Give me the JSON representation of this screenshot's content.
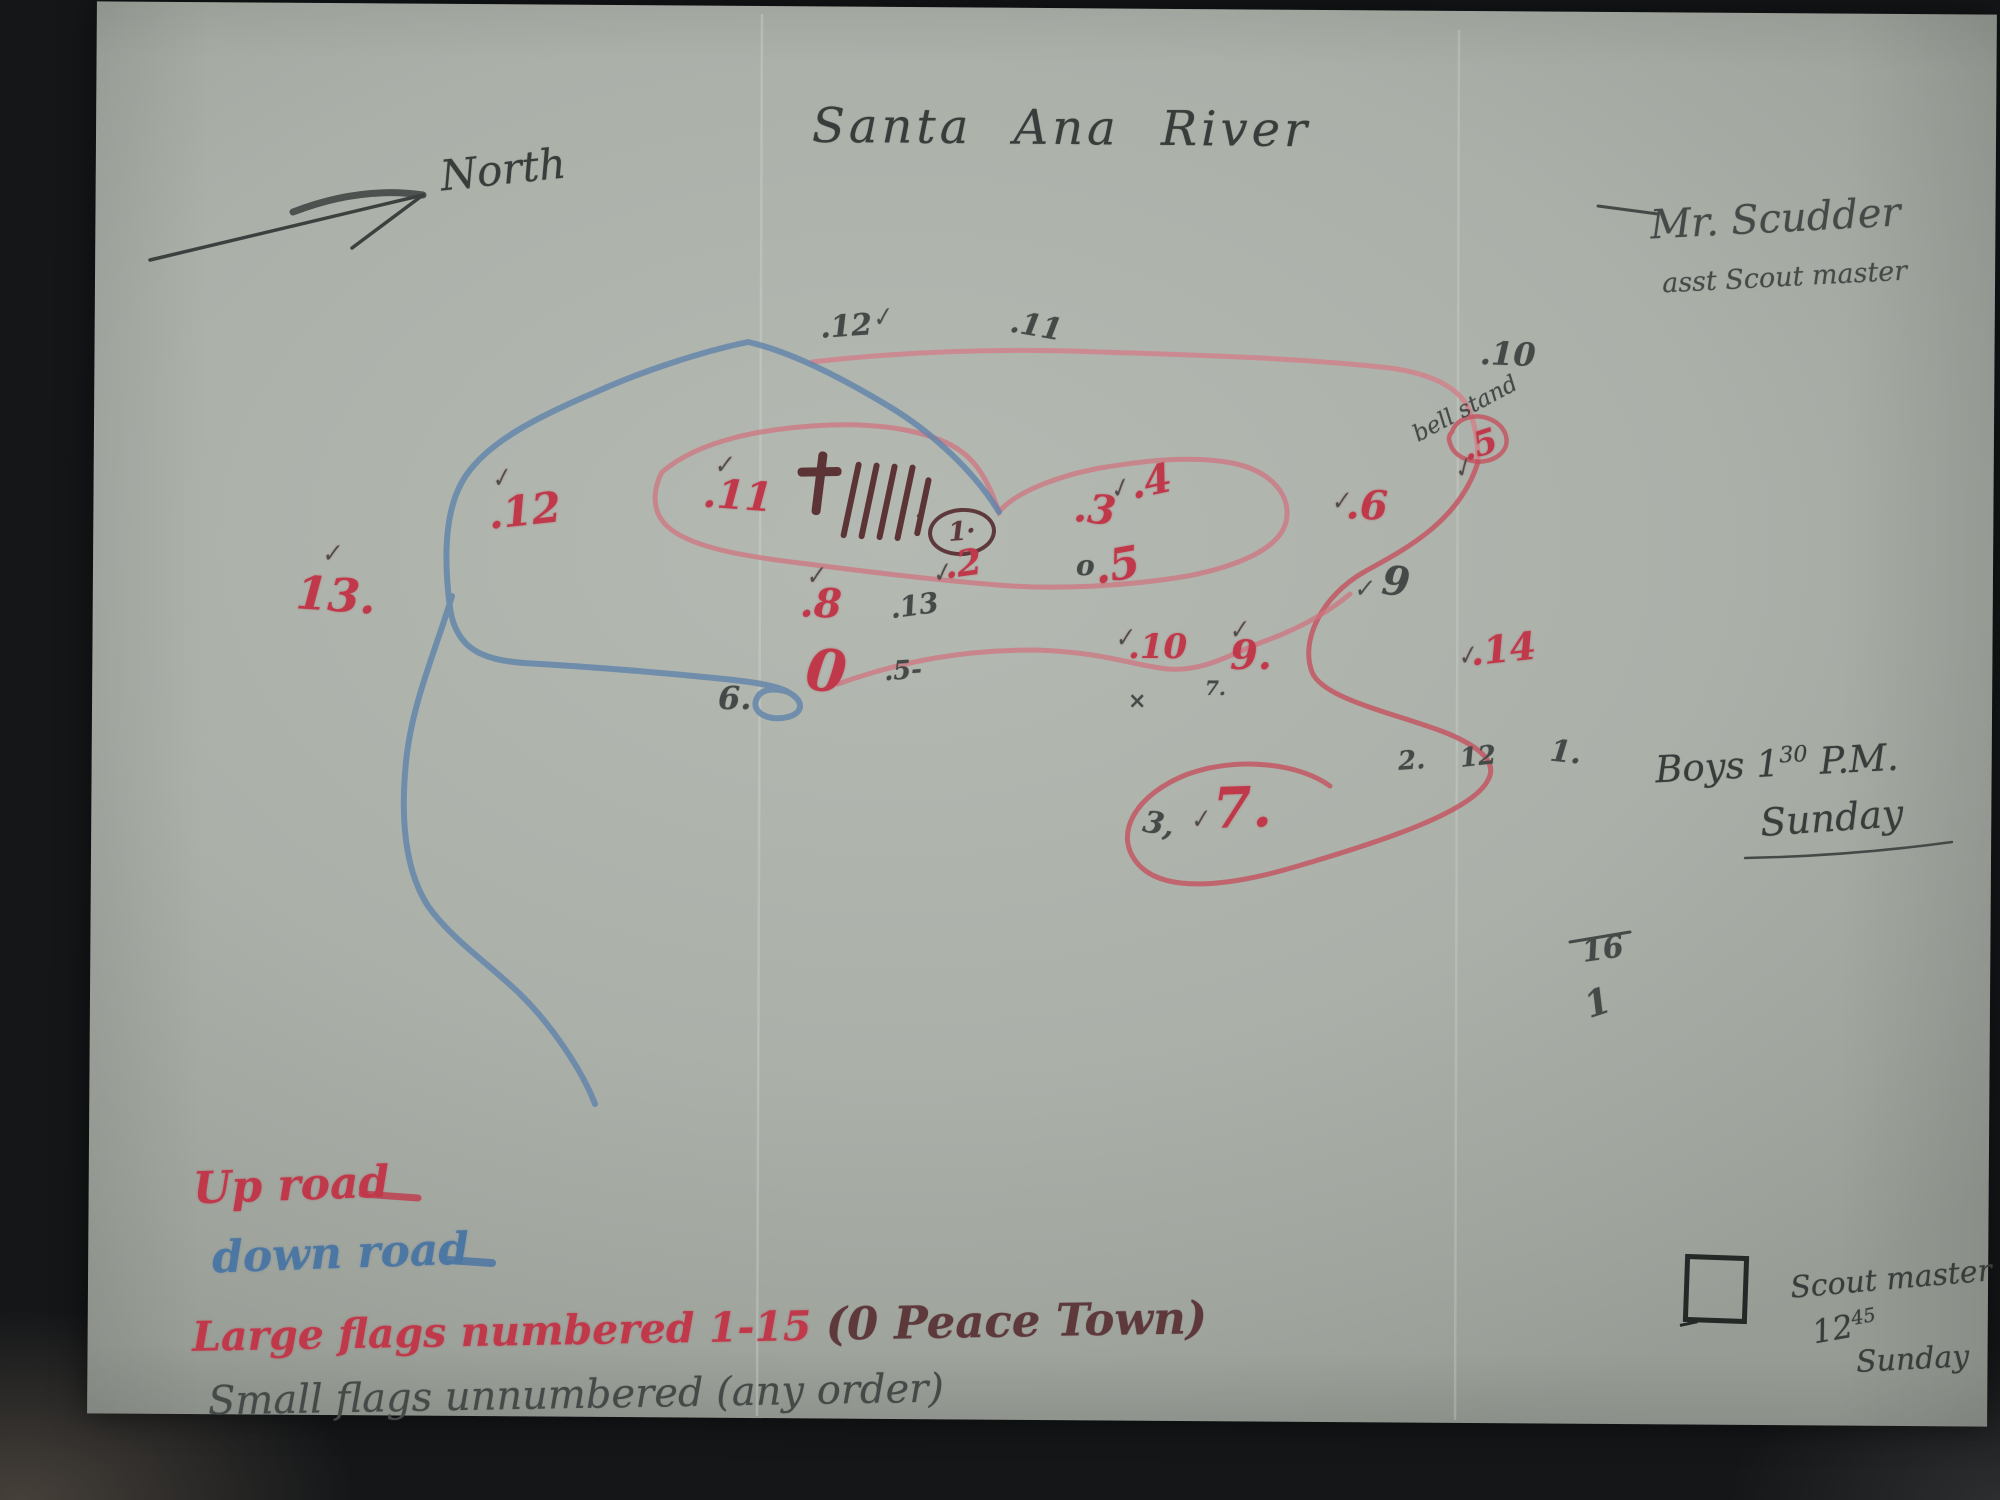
{
  "title": "Santa Ana River",
  "compass": {
    "label": "North"
  },
  "signature": {
    "line1": "Mr. Scudder",
    "line2": "asst Scout master"
  },
  "notes": {
    "boys": {
      "prefix": "Boys 1",
      "sup": "30",
      "suffix": "P.M.",
      "line2": "Sunday"
    },
    "scoutmaster": {
      "line1": "Scout master",
      "time": "12",
      "time_sup": "45",
      "line2": "Sunday"
    }
  },
  "legend": {
    "up_road": {
      "label": "Up road",
      "color": "#c0394a"
    },
    "down_road": {
      "label": "down road",
      "color": "#4d77a3"
    },
    "large_flags": {
      "label": "Large flags numbered 1-15",
      "paren": "(0 Peace Town)",
      "color": "#c0394a",
      "paren_color": "#7c3036"
    },
    "small_flags": {
      "label": "Small flags unnumbered (any order)",
      "color": "#454a48"
    }
  },
  "map_labels": {
    "bell_stand": "bell stand",
    "circled_flag": "1·"
  },
  "glyphs": {
    "check": "✓"
  },
  "tally": {
    "count": 5
  },
  "colors": {
    "red_crayon": "#c0394a",
    "blue_crayon": "#4d77a3",
    "pencil": "#454a48",
    "maroon": "#5e393b",
    "paper": "#abb0a9"
  },
  "flags_large": [
    {
      "label": ".12",
      "x": 488,
      "y": 490,
      "size": 42,
      "rot": -6,
      "check": true,
      "cdx": 6,
      "cdy": -26
    },
    {
      "label": "13.",
      "x": 296,
      "y": 572,
      "size": 46,
      "rot": 4,
      "check": true,
      "cdx": 22,
      "cdy": -30
    },
    {
      "label": ".11",
      "x": 703,
      "y": 476,
      "size": 40,
      "rot": 4,
      "check": true,
      "cdx": 8,
      "cdy": -22
    },
    {
      "label": ".2",
      "x": 944,
      "y": 546,
      "size": 36,
      "rot": -8,
      "check": true,
      "cdx": -14,
      "cdy": 12
    },
    {
      "label": ".3",
      "x": 1074,
      "y": 490,
      "size": 40,
      "rot": 6,
      "check": false,
      "cdx": 0,
      "cdy": 0
    },
    {
      "label": ".4",
      "x": 1130,
      "y": 462,
      "size": 40,
      "rot": -12,
      "check": true,
      "cdx": -22,
      "cdy": 8
    },
    {
      "label": ".5",
      "x": 1094,
      "y": 544,
      "size": 44,
      "rot": -10,
      "check": false,
      "cdx": 0,
      "cdy": 0
    },
    {
      "label": ".5",
      "x": 1462,
      "y": 428,
      "size": 34,
      "rot": -18,
      "check": true,
      "cdx": -16,
      "cdy": 22
    },
    {
      "label": ".6",
      "x": 1346,
      "y": 486,
      "size": 40,
      "rot": 2,
      "check": true,
      "cdx": -16,
      "cdy": 4
    },
    {
      "label": "7.",
      "x": 1213,
      "y": 780,
      "size": 56,
      "rot": -2,
      "check": true,
      "cdx": -24,
      "cdy": 26
    },
    {
      "label": ".8",
      "x": 800,
      "y": 584,
      "size": 40,
      "rot": 2,
      "check": true,
      "cdx": 4,
      "cdy": -20
    },
    {
      "label": "9.",
      "x": 1230,
      "y": 636,
      "size": 40,
      "rot": 0,
      "check": true,
      "cdx": -2,
      "cdy": -18
    },
    {
      "label": ".10",
      "x": 1128,
      "y": 630,
      "size": 34,
      "rot": 0,
      "check": true,
      "cdx": -14,
      "cdy": -4
    },
    {
      "label": ".14",
      "x": 1470,
      "y": 630,
      "size": 38,
      "rot": -6,
      "check": true,
      "cdx": -14,
      "cdy": 10
    },
    {
      "label": "0",
      "x": 806,
      "y": 642,
      "size": 58,
      "rot": 6,
      "check": false,
      "cdx": 0,
      "cdy": 0
    }
  ],
  "flags_small": [
    {
      "label": ".12",
      "x": 820,
      "y": 312,
      "size": 30,
      "rot": -4,
      "check": true,
      "cdx": 52,
      "cdy": -4
    },
    {
      "label": ".11",
      "x": 1010,
      "y": 312,
      "size": 30,
      "rot": 10,
      "check": false,
      "cdx": 0,
      "cdy": 0
    },
    {
      "label": ".10",
      "x": 1480,
      "y": 338,
      "size": 32,
      "rot": 2,
      "check": false,
      "cdx": 0,
      "cdy": 0
    },
    {
      "label": ".13",
      "x": 890,
      "y": 592,
      "size": 28,
      "rot": -8,
      "check": false,
      "cdx": 0,
      "cdy": 0
    },
    {
      "label": ".5-",
      "x": 884,
      "y": 658,
      "size": 26,
      "rot": -4,
      "check": false,
      "cdx": 0,
      "cdy": 0
    },
    {
      "label": "6.",
      "x": 718,
      "y": 682,
      "size": 32,
      "rot": 0,
      "check": false,
      "cdx": 0,
      "cdy": 0
    },
    {
      "label": "9",
      "x": 1382,
      "y": 562,
      "size": 40,
      "rot": 6,
      "check": true,
      "cdx": -28,
      "cdy": 18
    },
    {
      "label": "o",
      "x": 1076,
      "y": 552,
      "size": 28,
      "rot": 0,
      "check": false,
      "cdx": 0,
      "cdy": 0
    },
    {
      "label": "3,",
      "x": 1143,
      "y": 810,
      "size": 30,
      "rot": 10,
      "check": false,
      "cdx": 0,
      "cdy": 0
    },
    {
      "label": "2.",
      "x": 1398,
      "y": 748,
      "size": 26,
      "rot": -4,
      "check": false,
      "cdx": 0,
      "cdy": 0
    },
    {
      "label": "12",
      "x": 1460,
      "y": 744,
      "size": 26,
      "rot": -6,
      "check": false,
      "cdx": 0,
      "cdy": 0
    },
    {
      "label": "1.",
      "x": 1550,
      "y": 738,
      "size": 30,
      "rot": 6,
      "check": false,
      "cdx": 0,
      "cdy": 0
    },
    {
      "label": "16",
      "x": 1582,
      "y": 935,
      "size": 30,
      "rot": -8,
      "check": false,
      "cdx": 0,
      "cdy": 0
    },
    {
      "label": "1",
      "x": 1585,
      "y": 985,
      "size": 36,
      "rot": -18,
      "check": false,
      "cdx": 0,
      "cdy": 0
    },
    {
      "label": "7.",
      "x": 1205,
      "y": 678,
      "size": 20,
      "rot": 0,
      "check": false,
      "cdx": 0,
      "cdy": 0
    },
    {
      "label": "×",
      "x": 1128,
      "y": 690,
      "size": 22,
      "rot": 0,
      "check": false,
      "cdx": 0,
      "cdy": 0
    }
  ]
}
